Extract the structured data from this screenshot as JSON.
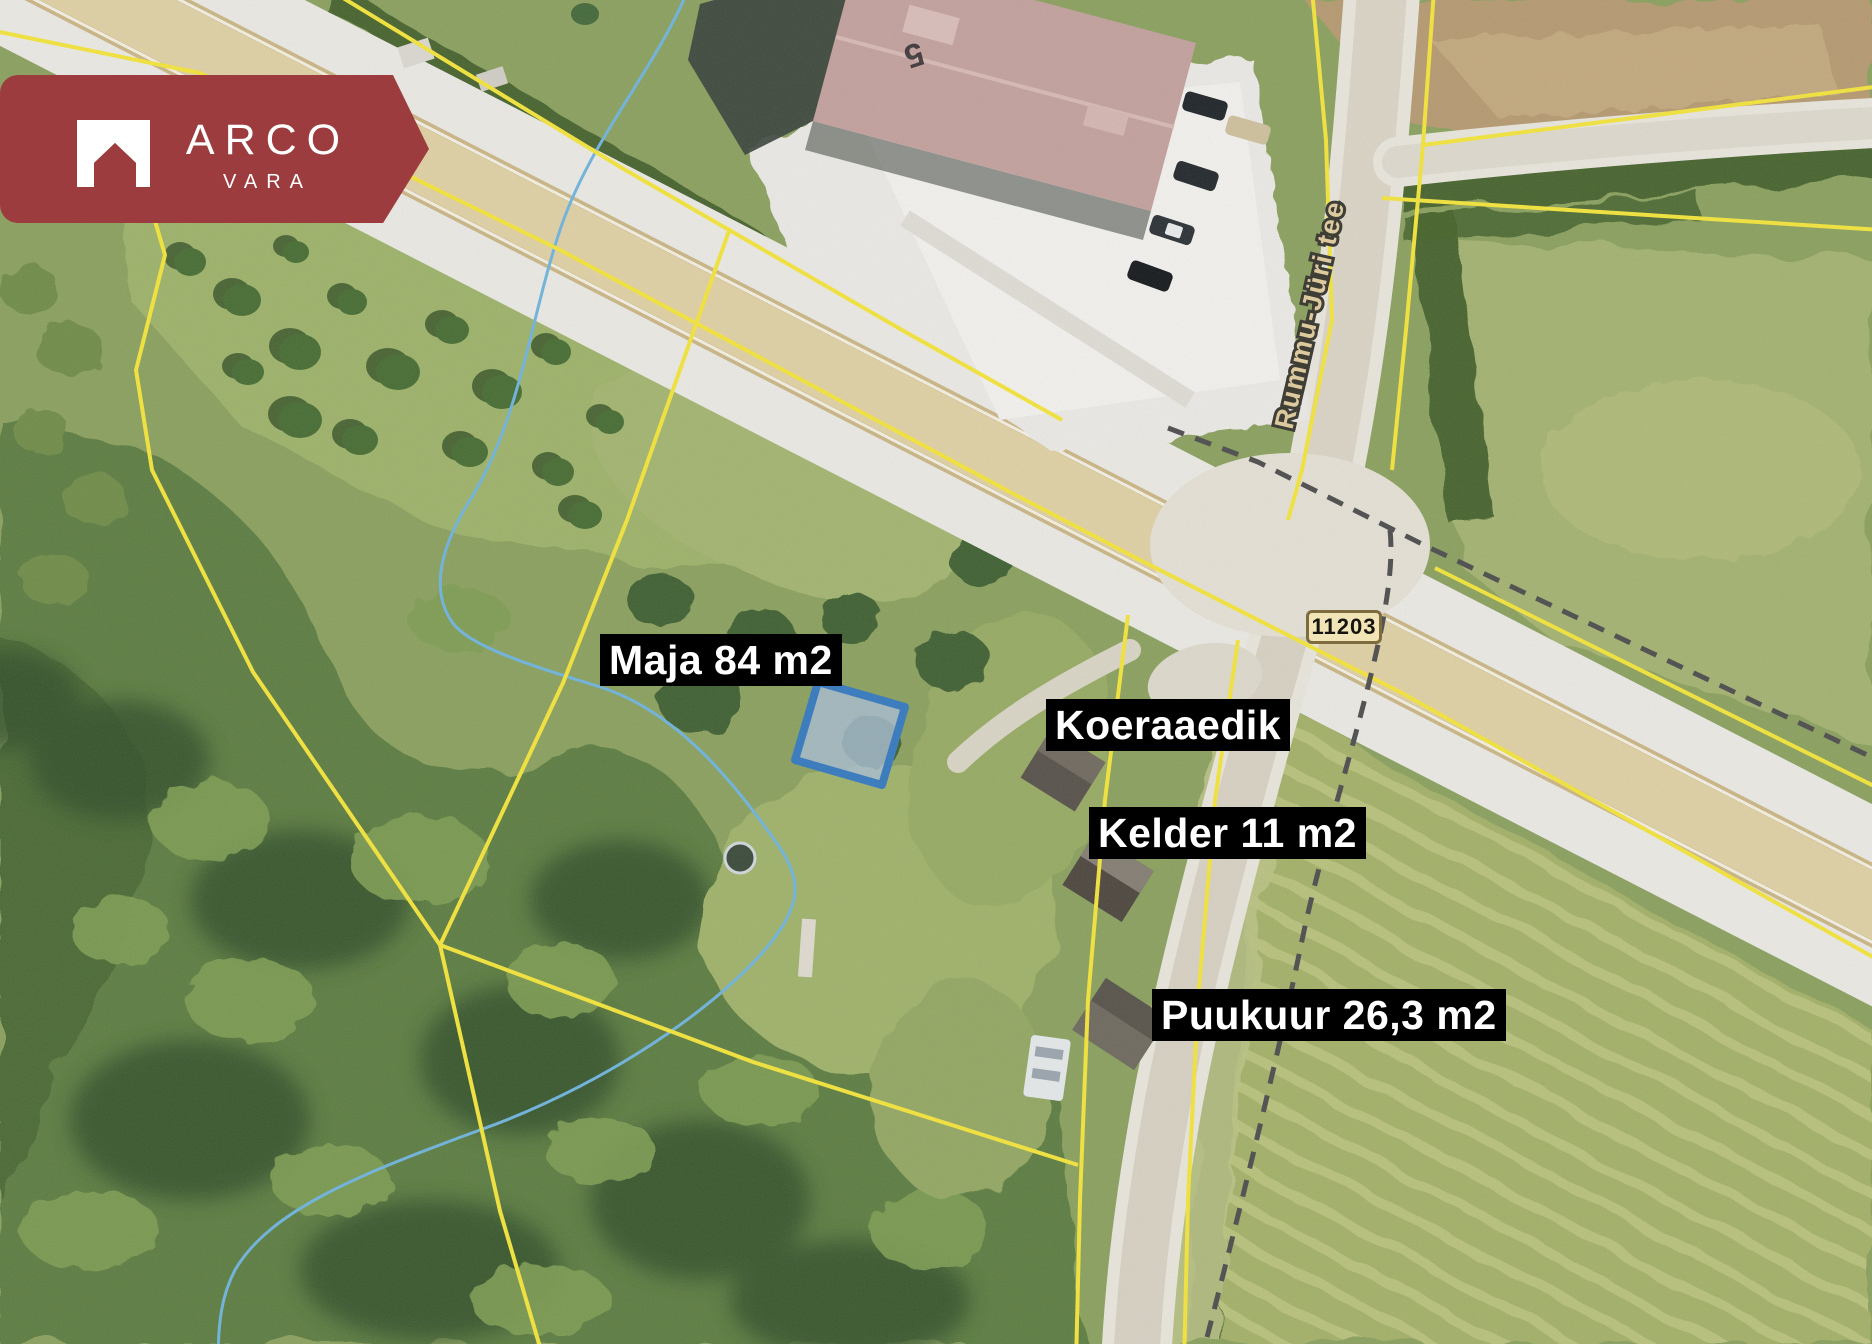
{
  "logo": {
    "brand": "ARCO",
    "sub": "VARA"
  },
  "map": {
    "annotations": [
      {
        "text": "Maja 84 m2"
      },
      {
        "text": "Koeraaedik"
      },
      {
        "text": "Kelder 11 m2"
      },
      {
        "text": "Puukuur 26,3 m2"
      }
    ],
    "road_badge": "11203",
    "street_name": "Rummu-Jüri tee",
    "house_number": "5"
  },
  "colors": {
    "banner_red": "#9c3c3e",
    "parcel_yellow": "#f2e33b",
    "highlight_blue": "#3579be",
    "stream_blue": "#6fb3dc",
    "label_bg": "#000000",
    "label_text": "#ffffff",
    "road_tan": "#decfa3",
    "badge_fill": "#f1e4b6"
  }
}
